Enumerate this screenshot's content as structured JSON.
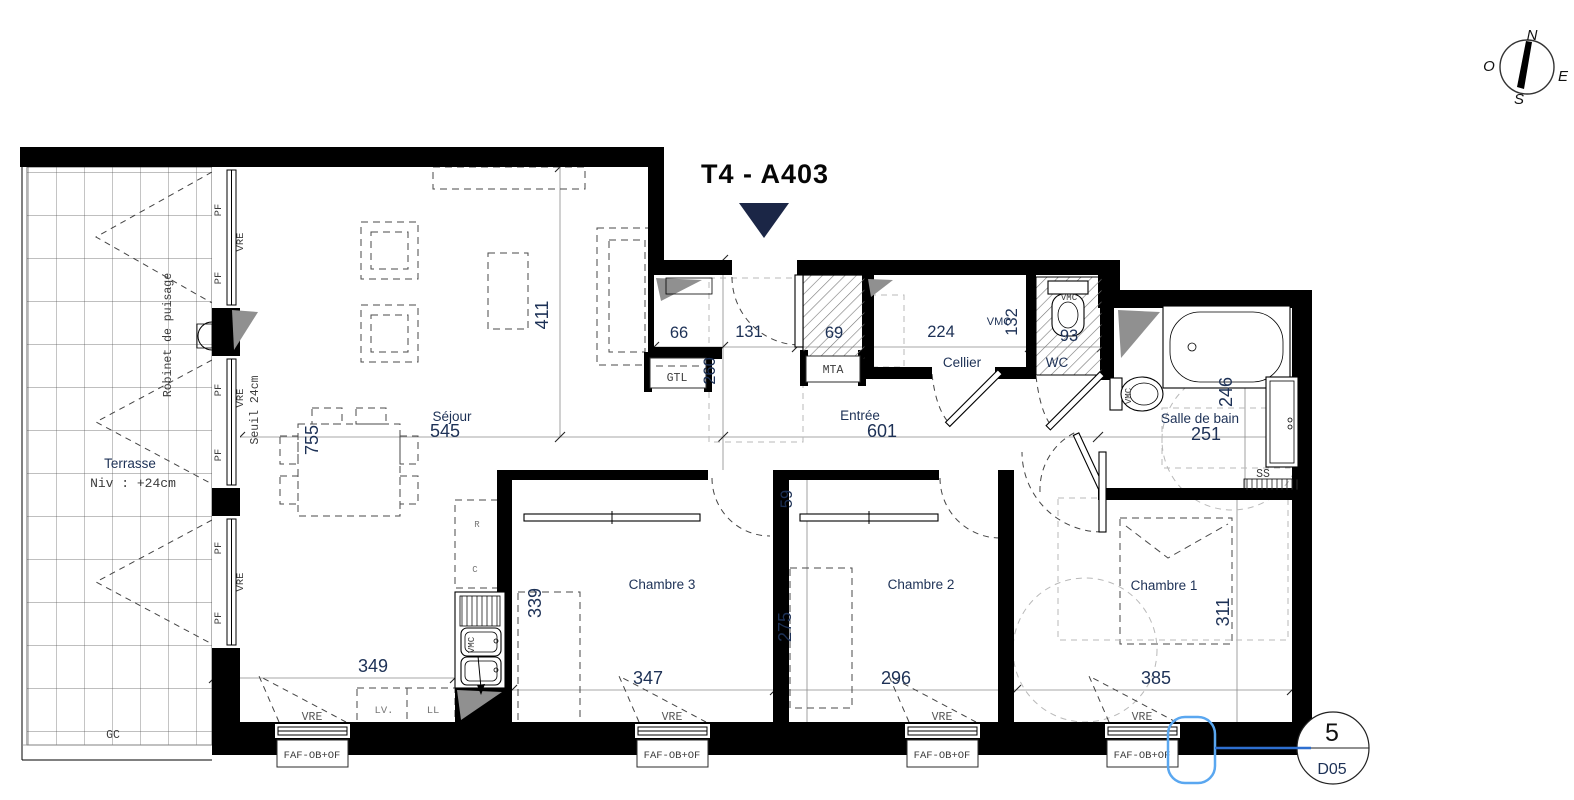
{
  "title": "T4 - A403",
  "compass": {
    "n": "N",
    "e": "E",
    "s": "S",
    "o": "O"
  },
  "terrace": {
    "name": "Terrasse",
    "level": "Niv : +24cm",
    "gc": "GC",
    "tap": "Robinet de puisage",
    "threshold": "Seuil 24cm"
  },
  "rooms": {
    "sejour": {
      "name": "Séjour",
      "w": "545",
      "h": "755",
      "h_right": "411",
      "kitchen_w": "349"
    },
    "entree": {
      "name": "Entrée",
      "w": "601",
      "niche_w": "66",
      "door_w": "131",
      "niche_h": "260",
      "duct_w": "69"
    },
    "cellier": {
      "name": "Cellier",
      "w": "224",
      "h": "132"
    },
    "wc": {
      "name": "WC",
      "w": "93"
    },
    "bath": {
      "name": "Salle de bain",
      "w": "251",
      "h": "246"
    },
    "ch1": {
      "name": "Chambre 1",
      "w": "385",
      "h": "311"
    },
    "ch2": {
      "name": "Chambre 2",
      "w": "296",
      "h": "275",
      "closet": "59"
    },
    "ch3": {
      "name": "Chambre 3",
      "w": "347",
      "h": "339"
    }
  },
  "tags": {
    "pf": "PF",
    "vre": "VRE",
    "vmc": "VMC",
    "gtl": "GTL",
    "mta": "MTA",
    "ss": "SS",
    "lv": "LV.",
    "ll": "LL",
    "appliance_r": "R",
    "appliance_c": "C",
    "window_type": "FAF-OB+OF"
  },
  "sheet": {
    "number": "5",
    "code": "D05"
  }
}
